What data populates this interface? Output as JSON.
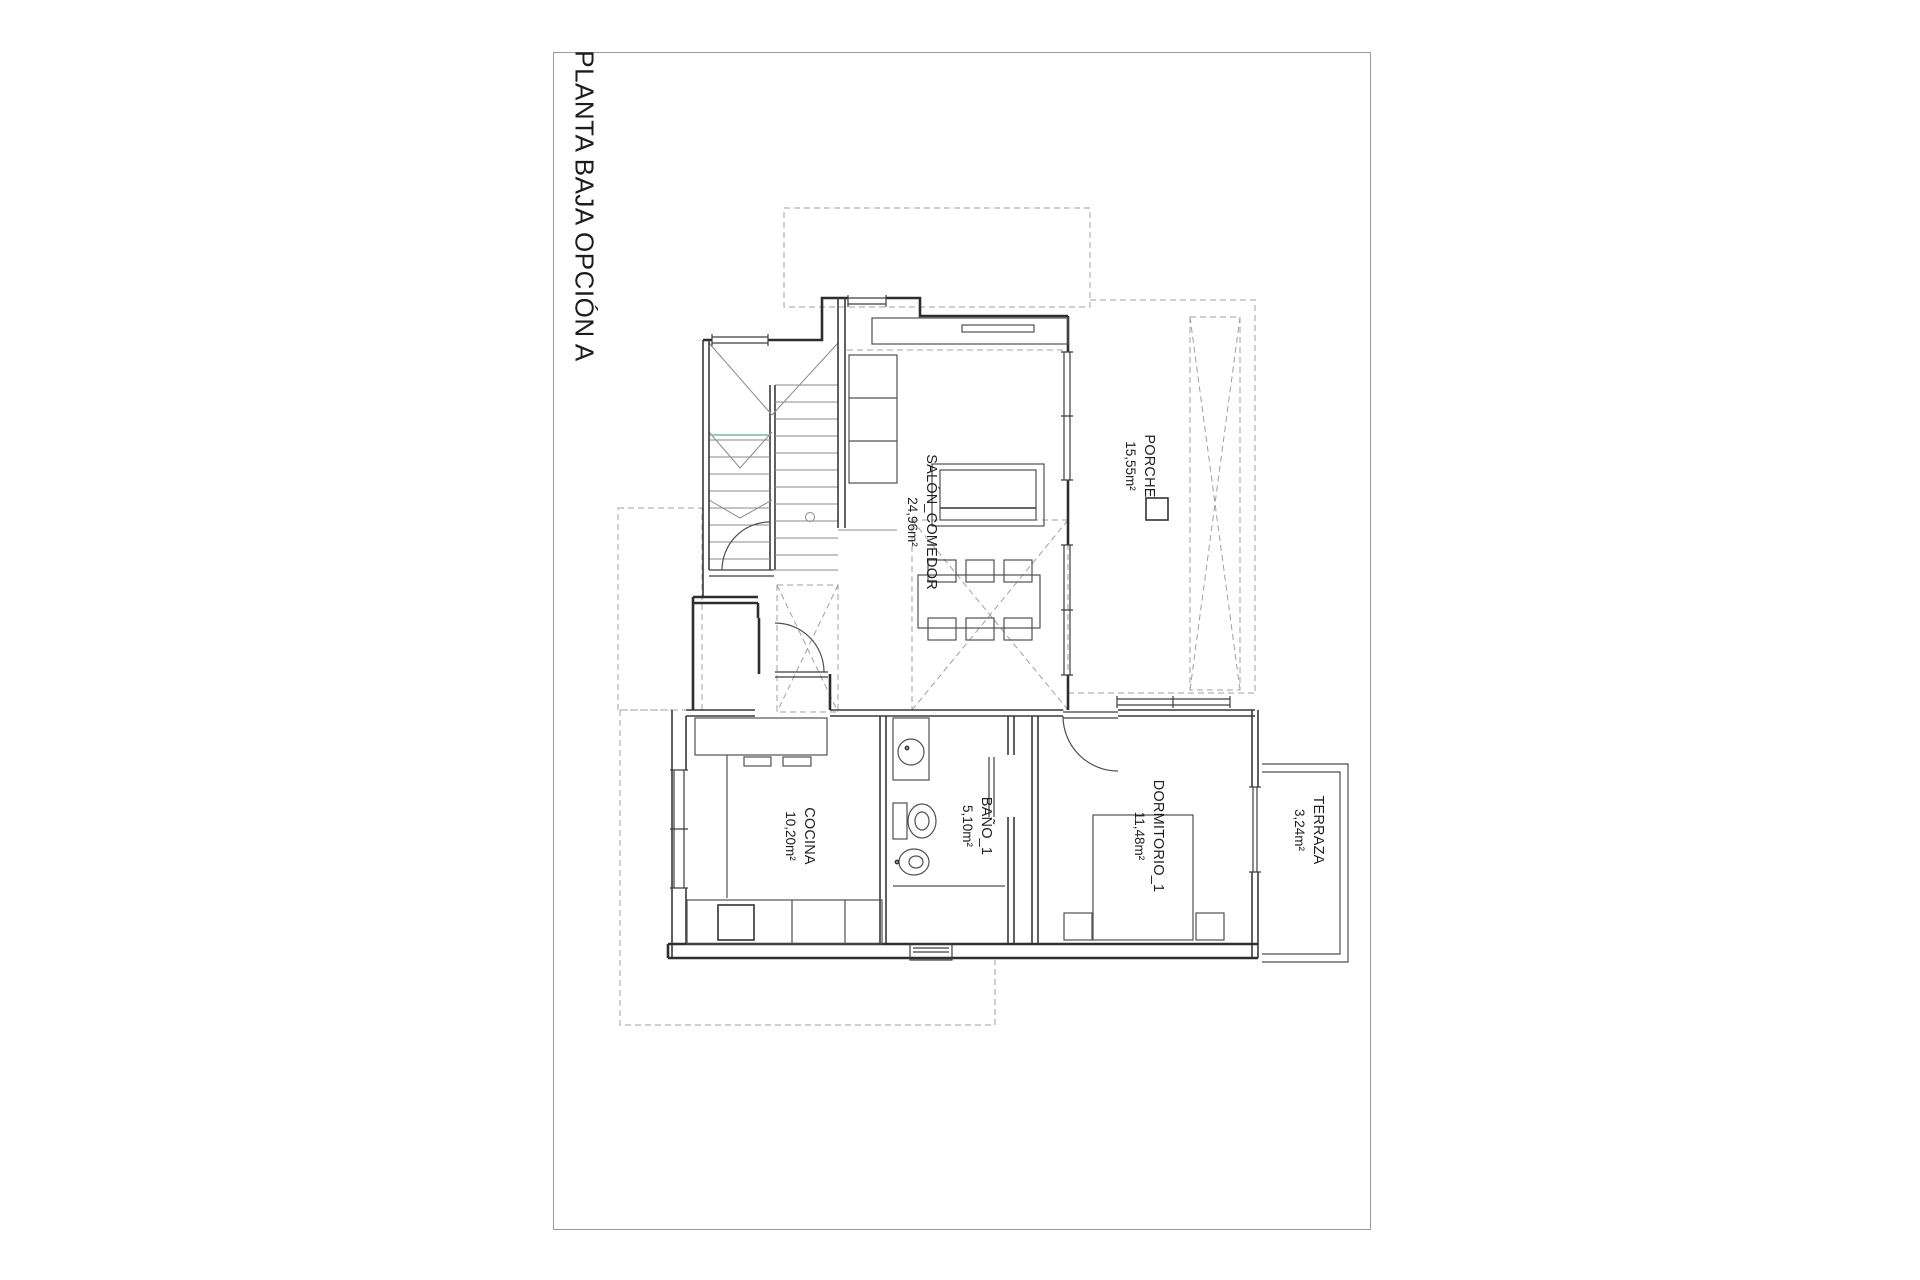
{
  "sheet": {
    "title": "PLANTA BAJA OPCIÓN A"
  },
  "rooms": {
    "porche": {
      "name": "PORCHE",
      "area": "15,55m²"
    },
    "salon": {
      "name": "SALÓN_COMEDOR",
      "area": "24,96m²"
    },
    "cocina": {
      "name": "COCINA",
      "area": "10,20m²"
    },
    "bano": {
      "name": "BAÑO_1",
      "area": "5,10m²"
    },
    "dormitorio": {
      "name": "DORMITORIO_1",
      "area": "11,48m²"
    },
    "terraza": {
      "name": "TERRAZA",
      "area": "3,24m²"
    }
  },
  "colors": {
    "wall": "#2e2e2e",
    "dashed_outline": "#a0a0a0",
    "stair_accent_teal": "#7ab5b1",
    "sheet_border": "#9a9a9a"
  }
}
